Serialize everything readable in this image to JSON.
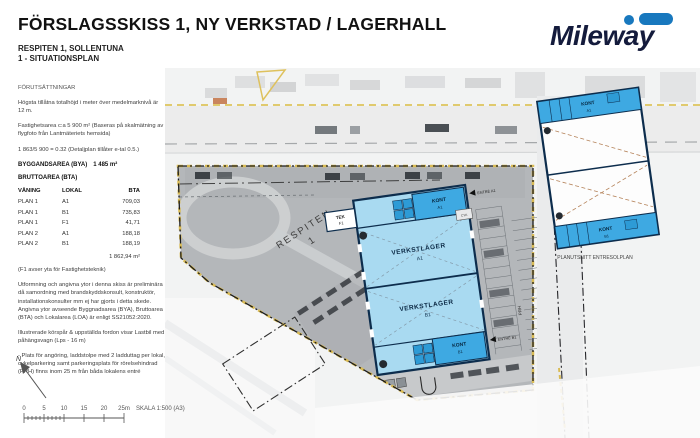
{
  "header": {
    "title": "FÖRSLAGSSKISS 1, NY VERKSTAD / LAGERHALL",
    "subtitle1": "RESPITEN 1, SOLLENTUNA",
    "subtitle2": "1 - SITUATIONSPLAN"
  },
  "logo": {
    "text": "Mileway"
  },
  "colors": {
    "logo_navy": "#141b3c",
    "logo_blue": "#1878be",
    "building_fill": "#a9daf1",
    "kont_fill": "#3ea9e2",
    "outline_navy": "#0d2d4d",
    "boundary_yellow": "#d9bb55"
  },
  "notes": {
    "section_title": "FÖRUTSÄTTNINGAR",
    "p1": "Högsta tillåtna totalhöjd i meter över medelmarknivå är 12 m.",
    "p2": "Fastighetsarea c:a 5 900 m² (Baseras på skalmätning av flygfoto från Lantmäteriets hemsida)",
    "p3": "1 863/5 900 = 0.32 (Detaljplan tillåter e-tal 0.5.)",
    "bya_label": "BYGGANDSAREA (BYA)",
    "bya_value": "1 485 m²",
    "bta_label": "BRUTTOAREA (BTA)",
    "table": {
      "headers": [
        "VÅNING",
        "LOKAL",
        "BTA"
      ],
      "rows": [
        [
          "PLAN 1",
          "A1",
          "709,03"
        ],
        [
          "PLAN 1",
          "B1",
          "735,83"
        ],
        [
          "PLAN 1",
          "F1",
          "41,71"
        ],
        [
          "PLAN 2",
          "A1",
          "188,18"
        ],
        [
          "PLAN 2",
          "B1",
          "188,19"
        ]
      ],
      "total": "1 862,94 m²"
    },
    "f1_note": "(F1 avser yta för Fastighetsteknik)",
    "p4": "Utformning och angivna ytor i denna skiss är preliminära då samordning med brandskyddskonsult, konstruktör, installationskonsulter mm ej har gjorts i detta skede. Angivna ytor avseende Byggnadsarea (BYA), Bruttoarea (BTA) och Lokalarea (LOA) är enligt SS21052:2020.",
    "p5": "Illustrerade körspår & uppställda fordon visar Lastbil med påhängsvagn (Lps - 16 m)",
    "p6": "- Plats för angöring, laddstolpe med 2 ladduttag per lokal, cykelparkering samt parkeringsplats för rörelsehindrad (PRH) finns inom 25 m från båda lokalens entré"
  },
  "plan": {
    "parcel_name": "RESPITEN",
    "parcel_number": "1",
    "hall_a_label": "VERKSTLAGER",
    "hall_a_code": "A1",
    "hall_b_label": "VERKSTLAGER",
    "hall_b_code": "B1",
    "kont_label": "KONT",
    "kont_a_code": "A1",
    "kont_b_code": "B1",
    "tek_label": "TEK",
    "tek_code": "F1",
    "prh_label": "PRH",
    "cyk_label": "CYK",
    "entrance_a": "ENTRÉ A1",
    "entrance_b": "ENTRÉ B1",
    "entresol": {
      "caption": "PLANUTSNITT ENTRESOLPLAN",
      "kont_label": "KONT",
      "kont_a_code": "A1",
      "kont_b_code": "B1"
    }
  },
  "north": {
    "label": "N"
  },
  "scalebar": {
    "ticks": [
      "0",
      "5",
      "10",
      "15",
      "20",
      "25m"
    ],
    "label": "SKALA 1:500 (A3)"
  }
}
